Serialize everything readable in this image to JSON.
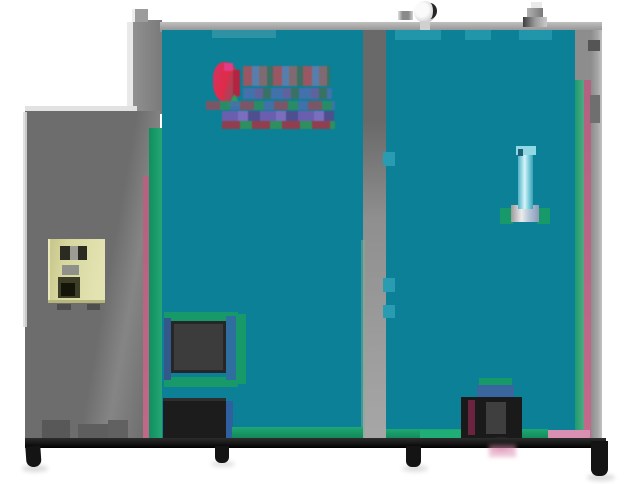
{
  "scene": {
    "type": "photograph",
    "description": "Low-resolution product photo of an industrial biomass boiler: large teal-panelled unit with gray frame, gray side control cabinet with pale-yellow controller box, red brand logo (illegible) on the upper left panel, vertical water-level sight glass on the right panel, two dark furnace/ash doors at lower left, a black burner box at lower right, black base rail with feet, pressure gauge and safety valve fittings on top",
    "legible_text": "none — brand logo and markings are too pixelated to read"
  },
  "logo": {
    "legible": false,
    "style": "red graphic mark followed by rows of red/blue pixelated characters with an underline band",
    "primary_color": "#e22a48"
  },
  "colors": {
    "background": "#ffffff",
    "teal": "#0b8096",
    "tealLight": "#2196ab",
    "green": "#17996a",
    "greenBright": "#1fae76",
    "pink": "#b3627f",
    "pinkLight": "#d98fb2",
    "frameGray": "#8d8d8d",
    "cabinetGray": "#6d6d6d",
    "cabinetLight": "#858585",
    "metalLight": "#d8d8d8",
    "boxYellow": "#d6d69e",
    "doorDark": "#3c3c3c",
    "black": "#161616",
    "logoRed": "#e22a48",
    "logoMagenta": "#e13c86",
    "logoGreen": "#27a05c",
    "logoBlue": "#4a6fae",
    "logoPurple": "#6a5fae",
    "maroon": "#6a2440",
    "glassLight": "#d6f6fa",
    "glassMid": "#57b7c9"
  },
  "parts": [
    "left-control-cabinet",
    "controller-box",
    "boiler-left-panel",
    "boiler-right-panel",
    "mid-divider",
    "brand-logo",
    "sight-glass",
    "upper-furnace-door",
    "lower-ash-door",
    "burner-box",
    "base-rail",
    "pressure-gauge",
    "safety-valve"
  ]
}
